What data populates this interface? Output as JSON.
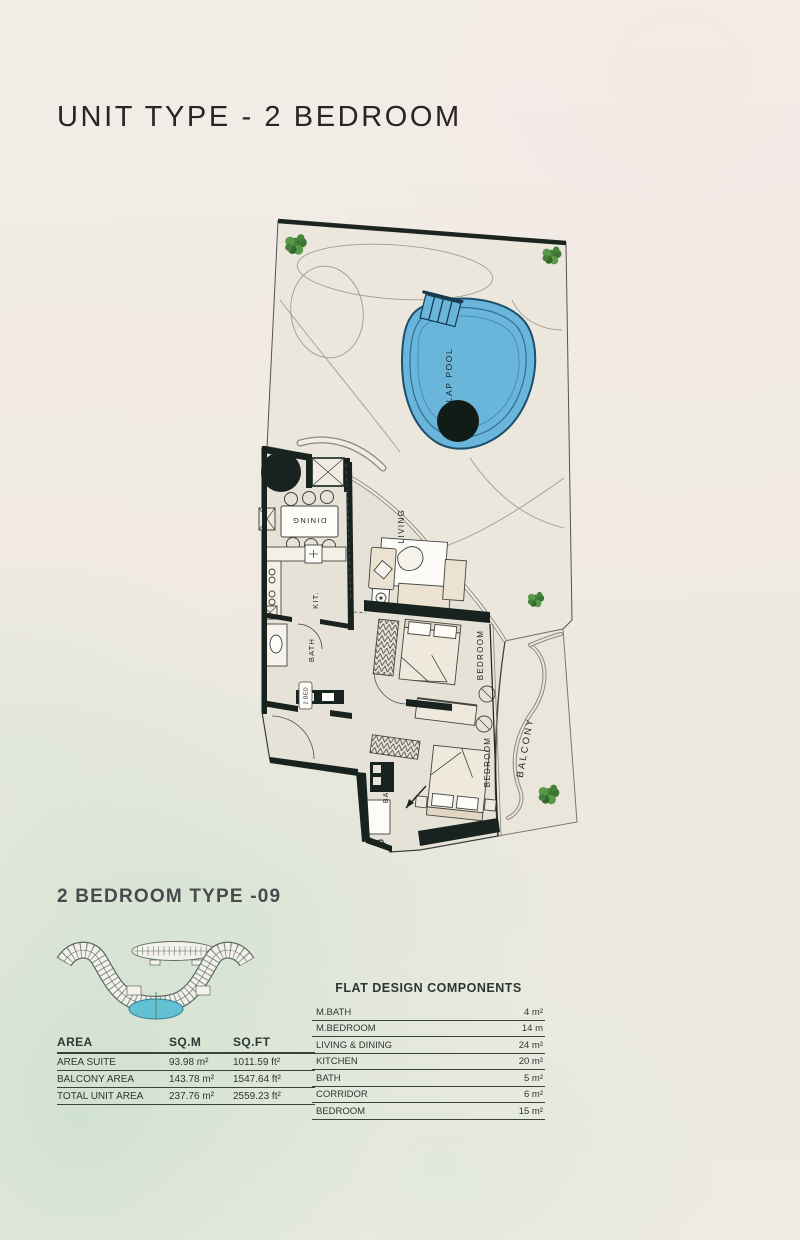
{
  "page": {
    "title": "UNIT TYPE - 2 BEDROOM",
    "section_title": "2 BEDROOM TYPE -09"
  },
  "floor_plan": {
    "labels": {
      "lap_pool": "LAP POOL",
      "dining": "DINING",
      "living": "LIVING",
      "kitchen": "KIT.",
      "bath": "BATH",
      "bed_tag": "2 BED",
      "bedroom": "BEDROOM",
      "balcony": "BALCONY"
    }
  },
  "area_table": {
    "headers": [
      "AREA",
      "SQ.M",
      "SQ.FT"
    ],
    "rows": [
      {
        "label": "AREA SUITE",
        "sqm": "93.98 m²",
        "sqft": "1011.59 ft²"
      },
      {
        "label": "BALCONY AREA",
        "sqm": "143.78 m²",
        "sqft": "1547.64 ft²"
      },
      {
        "label": "TOTAL UNIT AREA",
        "sqm": "237.76 m²",
        "sqft": "2559.23 ft²"
      }
    ]
  },
  "components_table": {
    "title": "FLAT DESIGN COMPONENTS",
    "rows": [
      {
        "label": "M.BATH",
        "value": "4 m²"
      },
      {
        "label": "M.BEDROOM",
        "value": "14 m"
      },
      {
        "label": "LIVING & DINING",
        "value": "24 m²"
      },
      {
        "label": "KITCHEN",
        "value": "20 m²"
      },
      {
        "label": "BATH",
        "value": "5 m²"
      },
      {
        "label": "CORRIDOR",
        "value": "6 m²"
      },
      {
        "label": "BEDROOM",
        "value": "15 m²"
      }
    ]
  },
  "colors": {
    "pool_fill": "#6ab5da",
    "pool_edge": "#1d4f6e",
    "wall_dark": "#18231f",
    "terrace_floor": "#ece7dd",
    "unit_floor": "#e7e2d8",
    "tree_green": "#45813a",
    "keyplan_pool": "#63c0d2"
  }
}
